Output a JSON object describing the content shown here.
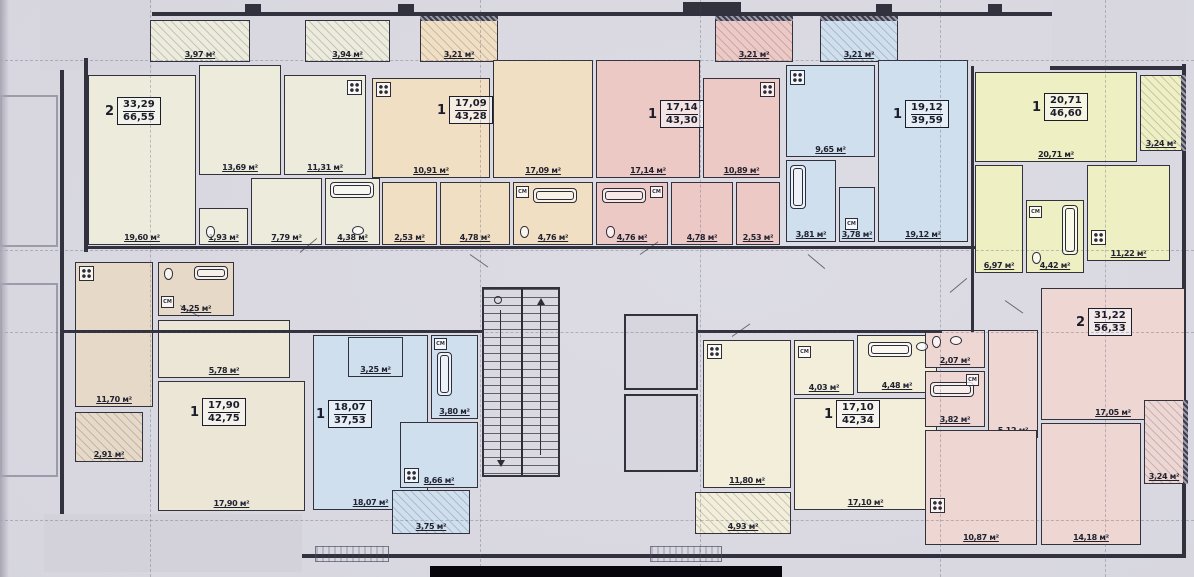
{
  "labels": {
    "washer": "СМ",
    "unit": "м²"
  },
  "colors": {
    "wall": "#32323e",
    "paper": "#d7d6df",
    "apartment_a": "#ecebdc",
    "apartment_b": "#f1dfc3",
    "apartment_c": "#edc9c5",
    "apartment_d": "#cfdfee",
    "apartment_e": "#efefc4",
    "apartment_f": "#ece6d6",
    "apartment_f_kitchen": "#e6d9c7",
    "apartment_g": "#cfdfee",
    "apartment_h": "#f2eeda",
    "apartment_i": "#eed6d3"
  },
  "apartments": [
    {
      "name": "apartment-1",
      "type": "2",
      "area_top": "33,29",
      "area_bottom": "66,55",
      "rooms": [
        {
          "name": "balcony-1",
          "label": "3,97 м²"
        },
        {
          "name": "balcony-2",
          "label": "3,94 м²"
        },
        {
          "name": "living",
          "label": "19,60 м²"
        },
        {
          "name": "bedroom",
          "label": "13,69 м²"
        },
        {
          "name": "kitchen",
          "label": "11,31 м²"
        },
        {
          "name": "wc",
          "label": "1,93 м²"
        },
        {
          "name": "hall",
          "label": "7,79 м²"
        },
        {
          "name": "bath",
          "label": "4,38 м²"
        }
      ]
    },
    {
      "name": "apartment-2",
      "type": "1",
      "area_top": "17,09",
      "area_bottom": "43,28",
      "rooms": [
        {
          "name": "balcony",
          "label": "3,21 м²"
        },
        {
          "name": "kitchen",
          "label": "10,91 м²"
        },
        {
          "name": "living",
          "label": "17,09 м²"
        },
        {
          "name": "wardrobe",
          "label": "2,53 м²"
        },
        {
          "name": "hall",
          "label": "4,78 м²"
        },
        {
          "name": "bath",
          "label": "4,76 м²"
        }
      ]
    },
    {
      "name": "apartment-3",
      "type": "1",
      "area_top": "17,14",
      "area_bottom": "43,30",
      "rooms": [
        {
          "name": "balcony",
          "label": "3,21 м²"
        },
        {
          "name": "living",
          "label": "17,14 м²"
        },
        {
          "name": "kitchen",
          "label": "10,89 м²"
        },
        {
          "name": "bath",
          "label": "4,76 м²"
        },
        {
          "name": "hall",
          "label": "4,78 м²"
        },
        {
          "name": "wardrobe",
          "label": "2,53 м²"
        }
      ]
    },
    {
      "name": "apartment-4",
      "type": "1",
      "area_top": "19,12",
      "area_bottom": "39,59",
      "rooms": [
        {
          "name": "balcony",
          "label": "3,21 м²"
        },
        {
          "name": "kitchen",
          "label": "9,65 м²"
        },
        {
          "name": "living",
          "label": "19,12 м²"
        },
        {
          "name": "bath",
          "label": "3,81 м²"
        },
        {
          "name": "hall",
          "label": "3,78 м²"
        }
      ]
    },
    {
      "name": "apartment-5",
      "type": "1",
      "area_top": "20,71",
      "area_bottom": "46,60",
      "rooms": [
        {
          "name": "living",
          "label": "20,71 м²"
        },
        {
          "name": "balcony",
          "label": "3,24 м²"
        },
        {
          "name": "hall",
          "label": "6,97 м²"
        },
        {
          "name": "bath",
          "label": "4,42 м²"
        },
        {
          "name": "kitchen",
          "label": "11,22 м²"
        }
      ]
    },
    {
      "name": "apartment-6",
      "type": "1",
      "area_top": "17,90",
      "area_bottom": "42,75",
      "rooms": [
        {
          "name": "kitchen",
          "label": "11,70 м²"
        },
        {
          "name": "bath",
          "label": "4,25 м²"
        },
        {
          "name": "hall",
          "label": "5,78 м²"
        },
        {
          "name": "living",
          "label": "17,90 м²"
        },
        {
          "name": "balcony",
          "label": "2,91 м²"
        }
      ]
    },
    {
      "name": "apartment-7",
      "type": "1",
      "area_top": "18,07",
      "area_bottom": "37,53",
      "rooms": [
        {
          "name": "living",
          "label": "18,07 м²"
        },
        {
          "name": "hall",
          "label": "3,25 м²"
        },
        {
          "name": "bath",
          "label": "3,80 м²"
        },
        {
          "name": "kitchen",
          "label": "8,66 м²"
        },
        {
          "name": "balcony",
          "label": "3,75 м²"
        }
      ]
    },
    {
      "name": "apartment-8",
      "type": "1",
      "area_top": "17,10",
      "area_bottom": "42,34",
      "rooms": [
        {
          "name": "kitchen",
          "label": "11,80 м²"
        },
        {
          "name": "hall",
          "label": "4,03 м²"
        },
        {
          "name": "bath",
          "label": "4,48 м²"
        },
        {
          "name": "living",
          "label": "17,10 м²"
        },
        {
          "name": "balcony",
          "label": "4,93 м²"
        }
      ]
    },
    {
      "name": "apartment-9",
      "type": "2",
      "area_top": "31,22",
      "area_bottom": "56,33",
      "rooms": [
        {
          "name": "wc",
          "label": "2,07 м²"
        },
        {
          "name": "bath",
          "label": "3,82 м²"
        },
        {
          "name": "hall",
          "label": "5,12 м²"
        },
        {
          "name": "living",
          "label": "17,05 м²"
        },
        {
          "name": "kitchen",
          "label": "10,87 м²"
        },
        {
          "name": "bedroom",
          "label": "14,18 м²"
        },
        {
          "name": "balcony",
          "label": "3,24 м²"
        }
      ]
    }
  ]
}
